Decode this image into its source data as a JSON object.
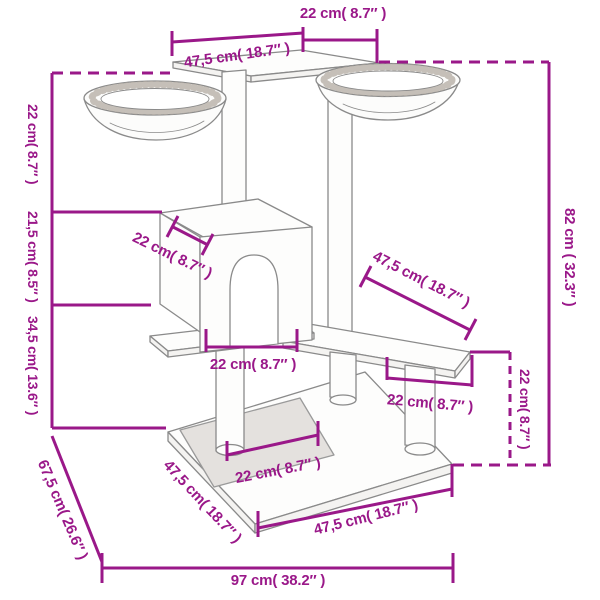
{
  "diagram": {
    "type": "product-dimension-diagram",
    "subject": "cat tree with scratching posts, two hammock bowls, cat house, platforms and base",
    "colors": {
      "dimension_lines": "#9A1889",
      "drawing_outline": "#8A8A8A",
      "mat_fill": "#E4E1DE",
      "background": "#FFFFFF"
    },
    "dimensions": {
      "top_platform_width": "22 cm( 8.7″ )",
      "top_platform_depth": "47,5 cm( 18.7″ )",
      "left_top_section_height": "22 cm( 8.7″ )",
      "left_mid_section_height": "21,5 cm( 8.5″ )",
      "left_lower_section_height": "34,5 cm( 13.6″ )",
      "house_roof_depth": "22 cm( 8.7″ )",
      "house_width": "22 cm( 8.7″ )",
      "mid_platform_depth": "47,5 cm( 18.7″ )",
      "mid_platform_width": "22 cm( 8.7″ )",
      "total_height": "82 cm ( 32.3″ )",
      "platform_to_base_height": "22 cm( 8.7″ )",
      "base_inner_width": "22 cm( 8.7″ )",
      "base_left_edge": "47,5 cm( 18.7″ )",
      "base_right_edge": "47,5 cm( 18.7″ )",
      "base_diagonal": "67,5 cm( 26.6″ )",
      "total_width": "97 cm( 38.2″ )"
    }
  }
}
